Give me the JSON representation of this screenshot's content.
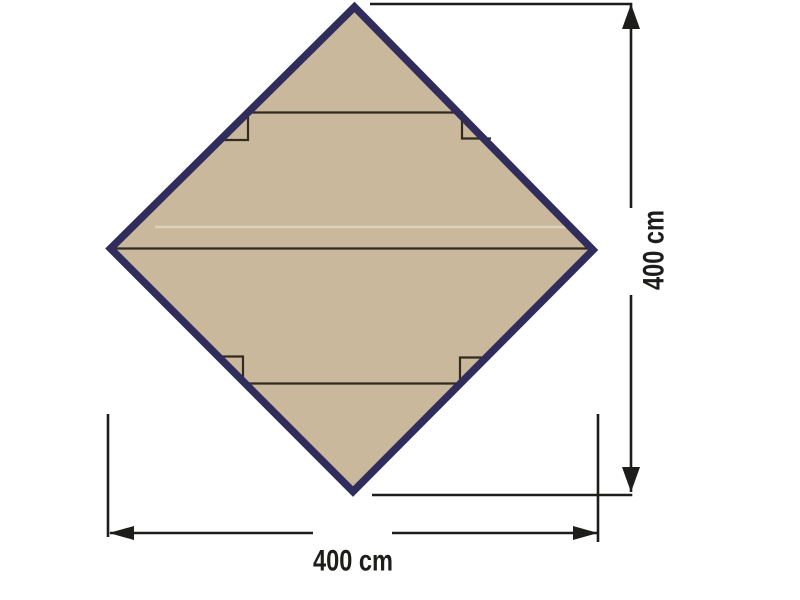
{
  "diagram": {
    "height_dimension": {
      "label": "400 cm"
    },
    "width_dimension": {
      "label": "400 cm"
    }
  },
  "colors": {
    "background": "#ffffff",
    "tarp_fill": "#c9b89c",
    "tarp_border": "#302d5d",
    "fold_line": "#332a20",
    "crease_highlight": "#ece6da",
    "dimension_line": "#1d1d1b"
  }
}
